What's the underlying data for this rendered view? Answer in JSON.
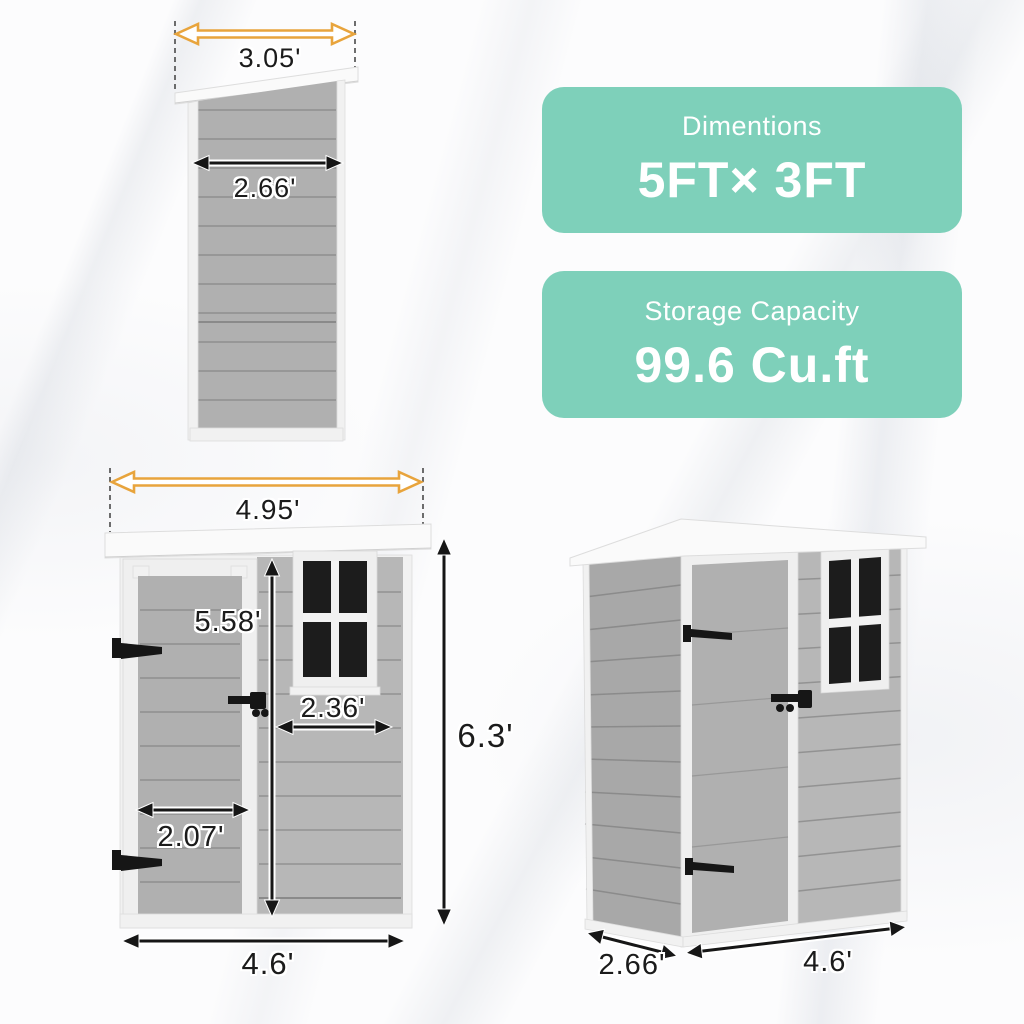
{
  "info_cards": [
    {
      "title": "Dimentions",
      "value": "5FT× 3FT"
    },
    {
      "title": "Storage Capacity",
      "value": "99.6 Cu.ft"
    }
  ],
  "views": {
    "side": {
      "labels": {
        "roof_width": "3.05'",
        "body_width": "2.66'"
      }
    },
    "front": {
      "labels": {
        "roof_width": "4.95'",
        "door_height": "5.58'",
        "window_section_width": "2.36'",
        "door_width": "2.07'",
        "overall_height": "6.3'",
        "base_width": "4.6'"
      }
    },
    "perspective": {
      "labels": {
        "depth": "2.66'",
        "width": "4.6'"
      }
    }
  },
  "colors": {
    "accent_teal": "#7ED0BA",
    "arrow_orange": "#E8A43C",
    "shed_gray": "#B7B7B7",
    "shed_gray_dark": "#A8A8A8",
    "window_pane": "#1C1C1C"
  }
}
